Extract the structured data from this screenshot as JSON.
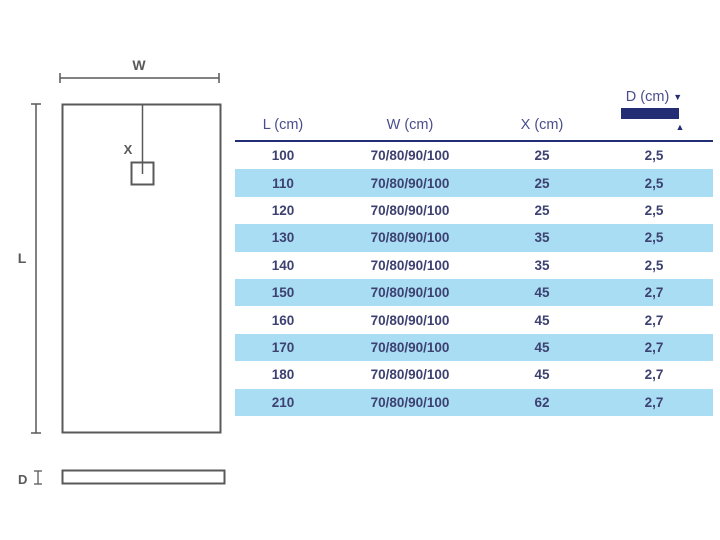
{
  "diagram": {
    "top_view": {
      "width_label": "W",
      "length_label": "L",
      "drain_label": "X"
    },
    "side_view": {
      "depth_label": "D"
    }
  },
  "table": {
    "headers": {
      "l": "L (cm)",
      "w": "W (cm)",
      "x": "X (cm)",
      "d": "D (cm)"
    },
    "rows": [
      {
        "l": "100",
        "w": "70/80/90/100",
        "x": "25",
        "d": "2,5"
      },
      {
        "l": "110",
        "w": "70/80/90/100",
        "x": "25",
        "d": "2,5"
      },
      {
        "l": "120",
        "w": "70/80/90/100",
        "x": "25",
        "d": "2,5"
      },
      {
        "l": "130",
        "w": "70/80/90/100",
        "x": "35",
        "d": "2,5"
      },
      {
        "l": "140",
        "w": "70/80/90/100",
        "x": "35",
        "d": "2,5"
      },
      {
        "l": "150",
        "w": "70/80/90/100",
        "x": "45",
        "d": "2,7"
      },
      {
        "l": "160",
        "w": "70/80/90/100",
        "x": "45",
        "d": "2,7"
      },
      {
        "l": "170",
        "w": "70/80/90/100",
        "x": "45",
        "d": "2,7"
      },
      {
        "l": "180",
        "w": "70/80/90/100",
        "x": "45",
        "d": "2,7"
      },
      {
        "l": "210",
        "w": "70/80/90/100",
        "x": "62",
        "d": "2,7"
      }
    ]
  },
  "icons": {
    "depth_arrow_down": "▼",
    "depth_arrow_up": "▲"
  },
  "colors": {
    "navy": "#232d74",
    "header_text": "#4a4d8c",
    "cell_text": "#3d4170",
    "row_alt": "#a9ddf4",
    "diagram_line": "#58595b"
  }
}
